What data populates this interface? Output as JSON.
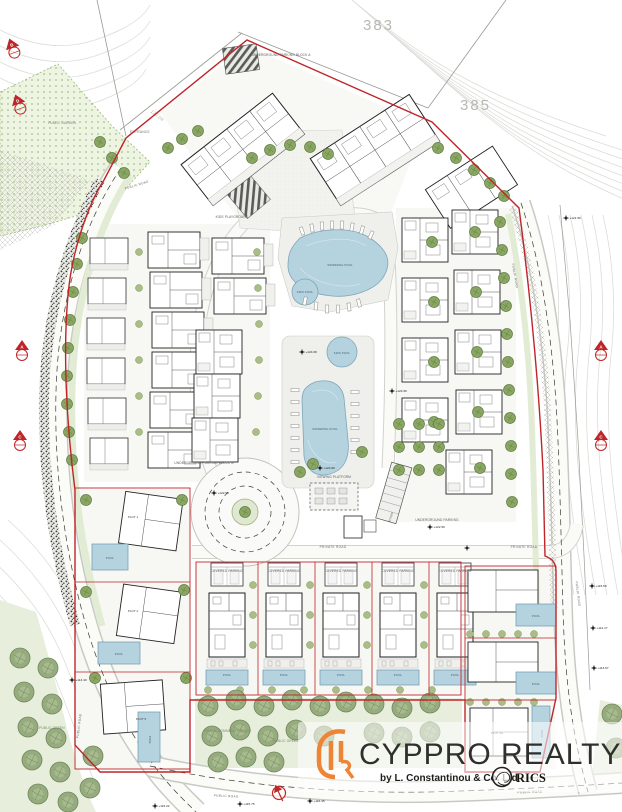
{
  "parcels": {
    "left": "383",
    "right": "385"
  },
  "contours": {
    "c1": "126.04",
    "c2": "123.61",
    "c3": "116.00"
  },
  "areas": {
    "public_garden": "PUBLIC GARDEN",
    "public_green": "PUBLIC GREEN",
    "public_community_space": "PUBLIC COMMUNITY SPACE",
    "public_green_bottom": "PUBLIC GREEN"
  },
  "roads": {
    "public_road": "PUBLIC ROAD",
    "private_road": "PRIVATE ROAD",
    "ramp": "RAMP",
    "entrance": "ENTRANCE"
  },
  "facilities": {
    "underground_parking_a": "UNDERGROUND PARKING BLOCK A",
    "underground_parking_b": "UNDERGROUND PARKING BLOCK B",
    "underground_parking": "UNDERGROUND PARKING",
    "viewing_platform": "VIEWING PLATFORM",
    "kids_playground": "KIDS PLAYGROUND",
    "swimming_pool": "SWIMMING POOL",
    "kids_pool": "KIDS POOL",
    "pool": "POOL",
    "covered_parking": "COVERED PARKING"
  },
  "plots": {
    "plot1": "PLOT 1",
    "plot2": "PLOT 2",
    "plot5": "PLOT 5",
    "plot4a": "PLOT 4A"
  },
  "elevations": [
    {
      "label": "+124.08"
    },
    {
      "label": "+124.50"
    },
    {
      "label": "+124.00"
    },
    {
      "label": "+122.50"
    },
    {
      "label": "+123.00"
    },
    {
      "label": "+122.50"
    },
    {
      "label": "+115.22"
    },
    {
      "label": "+115.75"
    },
    {
      "label": "+116.45"
    },
    {
      "label": "+113.40"
    },
    {
      "label": "+115.50"
    },
    {
      "label": "+113.67"
    },
    {
      "label": "+121.50"
    },
    {
      "label": "+114.17"
    }
  ],
  "sections": [
    {
      "letter": "A"
    },
    {
      "letter": "C"
    },
    {
      "letter": "A"
    },
    {
      "letter": "C"
    },
    {
      "letter": "B"
    },
    {
      "letter": "D"
    }
  ],
  "logo": {
    "brand": "CYPPRO REALTY",
    "byline": "by L. Constantinou & Co. Ltd",
    "rics": "RICS"
  },
  "colors": {
    "boundary_red": "#bf2528",
    "pool_blue": "#b5d2df",
    "tree_olive": "#8aa663",
    "tree_sage": "#96ac7e",
    "logo_orange": "#ee8435",
    "contour_gray": "#dcdcd8"
  }
}
